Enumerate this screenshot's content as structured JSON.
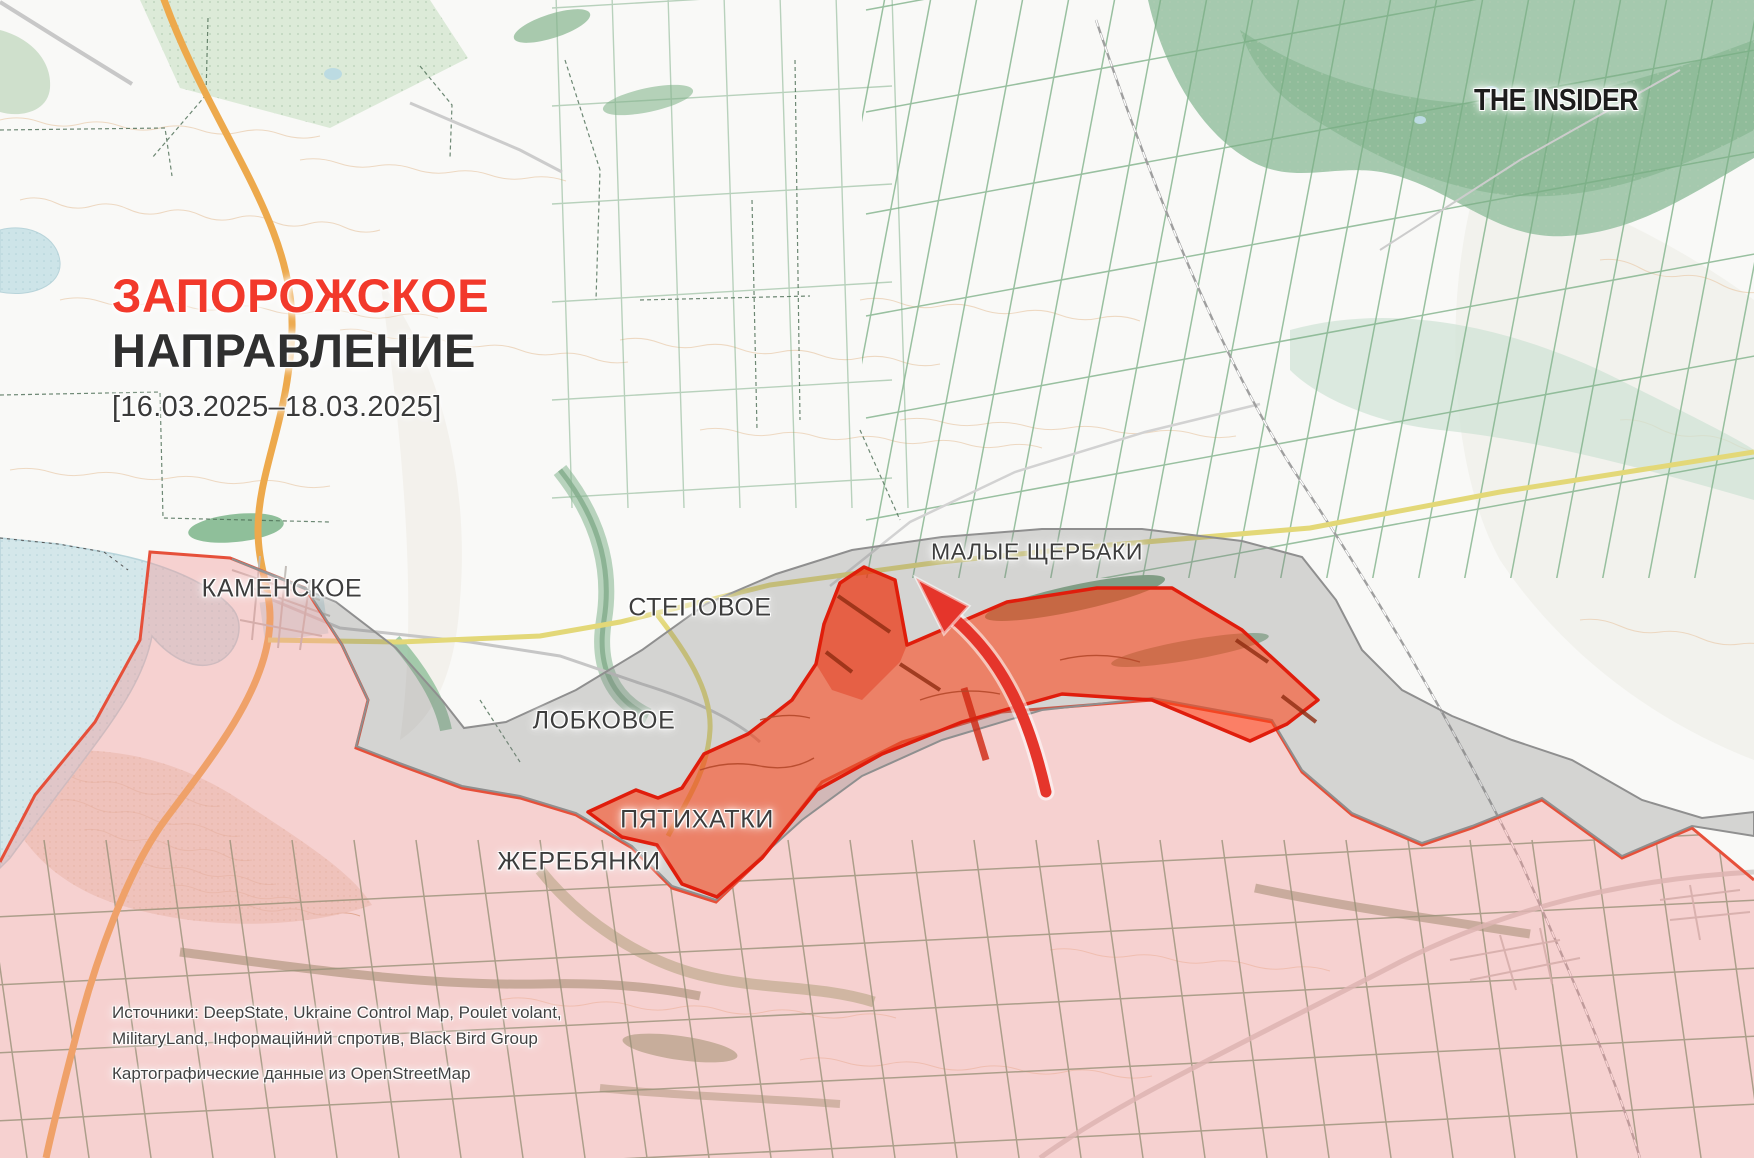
{
  "branding": {
    "logo_text": "THE INSIDER"
  },
  "title": {
    "line1": "ЗАПОРОЖСКОЕ",
    "line2": "НАПРАВЛЕНИЕ",
    "date_range": "[16.03.2025–18.03.2025]"
  },
  "map": {
    "places": {
      "kamenskoe": "КАМЕНСКОЕ",
      "stepovoe": "СТЕПОВОЕ",
      "malye_shcherbaki": "МАЛЫЕ ЩЕРБАКИ",
      "lobkovoe": "ЛОБКОВОЕ",
      "pyatikhatki": "ПЯТИХАТКИ",
      "zherebyanki": "ЖЕРЕБЯНКИ"
    },
    "legend": {
      "occupied_zone_fill": "#f6dada",
      "occupied_frontline": "#e6503a",
      "contested_zone_fill": "#d7d7d7",
      "contested_zone_border": "#8a8a8a",
      "advance_zone_fill": "#ff7b5c",
      "advance_zone_border": "#e01d0c",
      "advance_arrow": "#e5352b",
      "title_accent": "#f2392b"
    }
  },
  "sources": {
    "line1": "Источники: DeepState, Ukraine Control Map, Poulet volant,",
    "line2": "MilitaryLand, Інформаційний спротив, Black Bird Group",
    "line3": "Картографические данные из OpenStreetMap"
  }
}
